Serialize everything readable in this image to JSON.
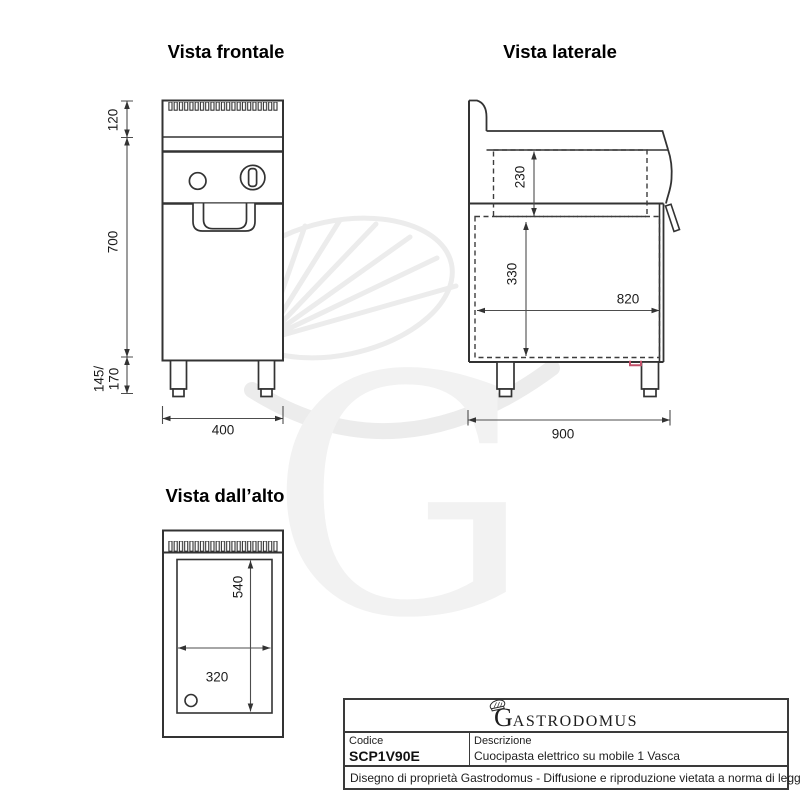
{
  "watermark": {
    "letter": "G"
  },
  "views": {
    "front": {
      "title": "Vista frontale",
      "dim_top": "120",
      "dim_body": "700",
      "dim_legs": "145/\n170",
      "dim_width": "400"
    },
    "side": {
      "title": "Vista laterale",
      "dim_tank_depth": "230",
      "dim_inner_height": "330",
      "dim_inner_depth": "820",
      "dim_depth": "900"
    },
    "top": {
      "title": "Vista dall’alto",
      "dim_tank_length": "540",
      "dim_tank_width": "320"
    }
  },
  "title_block": {
    "logo_initial": "G",
    "logo_rest": "ASTRODOMUS",
    "codice_label": "Codice",
    "codice_value": "SCP1V90E",
    "descrizione_label": "Descrizione",
    "descrizione_value": "Cuocipasta elettrico su mobile 1 Vasca",
    "note": "Disegno di proprietà Gastrodomus - Diffusione e riproduzione vietata a norma di legge."
  },
  "colors": {
    "line": "#333333",
    "dimension": "#4d4d4d",
    "watermark": "#ececec",
    "accent_red": "#c2506a"
  }
}
